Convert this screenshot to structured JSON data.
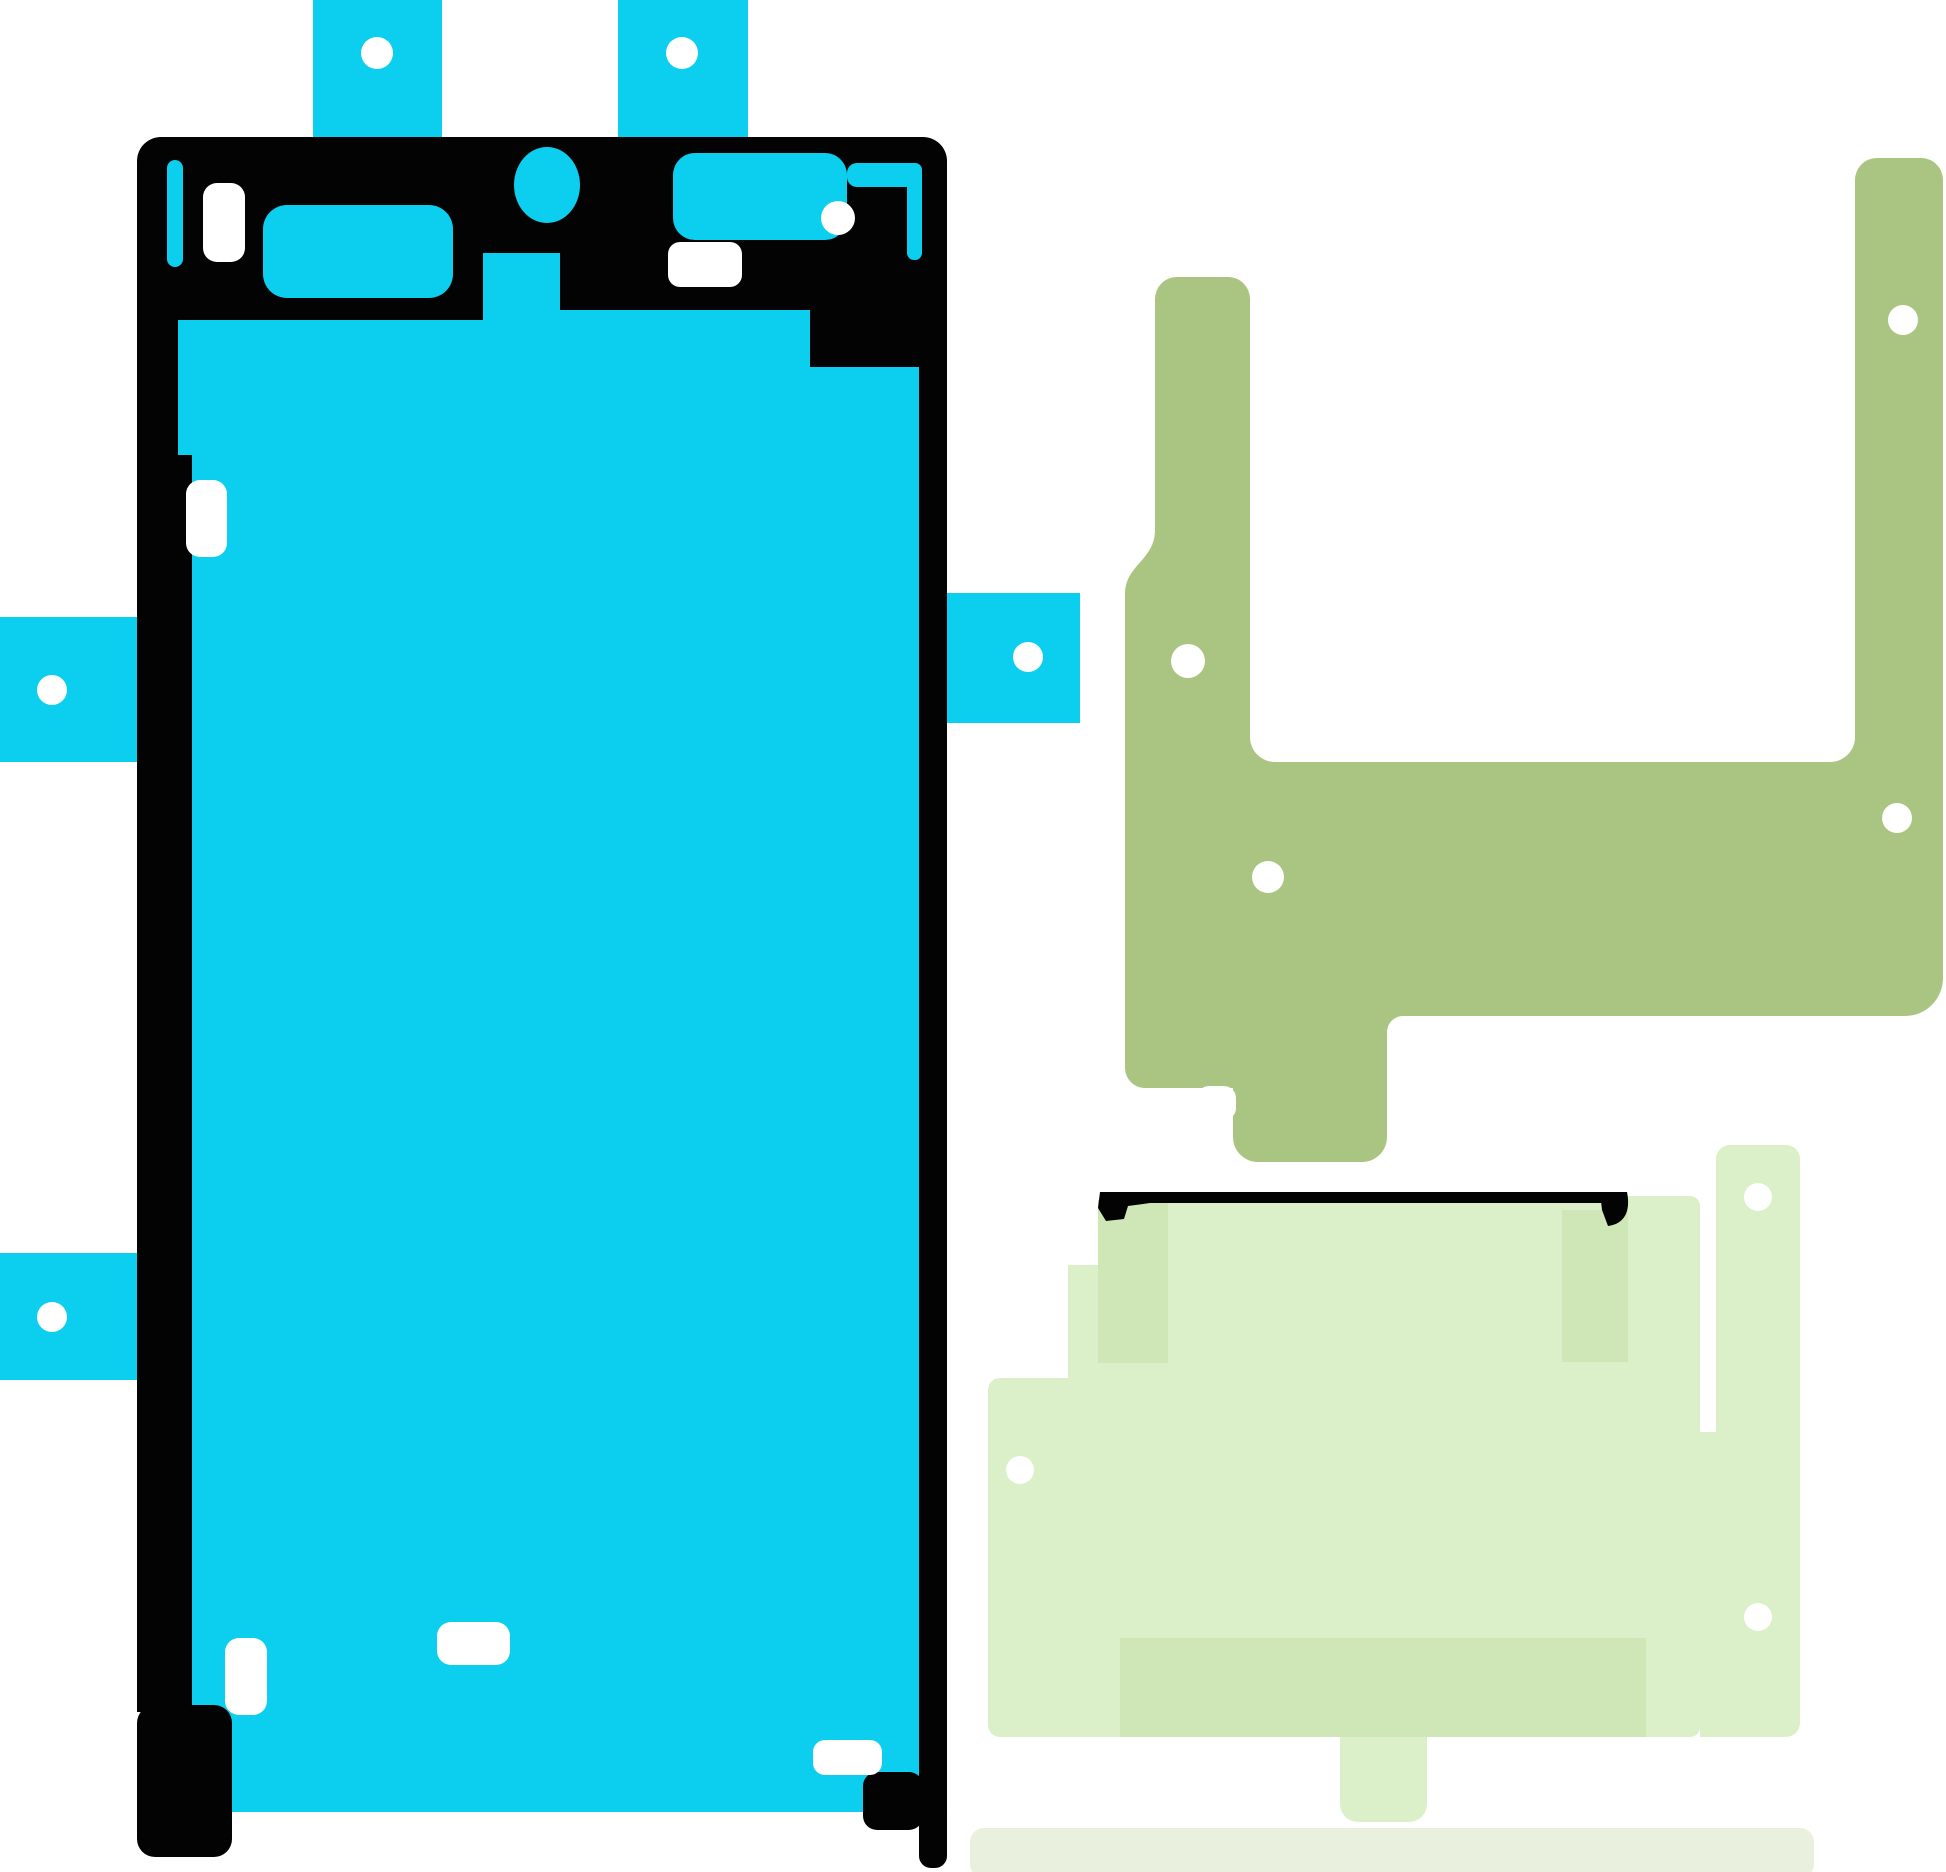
{
  "image": {
    "width": 1946,
    "height": 1872,
    "background": "#ffffff",
    "kind": "adhesive-rework-kit-product-image",
    "text_content": "none"
  },
  "colors": {
    "cyan": "#0cceee",
    "black": "#030303",
    "olive": "#a9c581",
    "light_green": "#dbf0c8",
    "medium_green": "#cfe7b6",
    "pale_green": "#eaf0de",
    "white": "#ffffff"
  },
  "pieces": {
    "display_adhesive": {
      "name": "display-gasket-adhesive",
      "color_key": "cyan",
      "liner_tab_holes": [
        {
          "cx": 377,
          "cy": 53,
          "r": 16
        },
        {
          "cx": 682,
          "cy": 53,
          "r": 16
        },
        {
          "cx": 52,
          "cy": 690,
          "r": 15
        },
        {
          "cx": 52,
          "cy": 1317,
          "r": 15
        },
        {
          "cx": 1028,
          "cy": 657,
          "r": 15
        }
      ],
      "inner_holes": [
        {
          "cx": 838,
          "cy": 218,
          "r": 17
        }
      ]
    },
    "bracket_adhesive": {
      "name": "bracket-adhesive-u-shape",
      "color_key": "olive",
      "holes": [
        {
          "cx": 1188,
          "cy": 661,
          "r": 17
        },
        {
          "cx": 1903,
          "cy": 320,
          "r": 15
        },
        {
          "cx": 1897,
          "cy": 818,
          "r": 15
        },
        {
          "cx": 1268,
          "cy": 877,
          "r": 16
        }
      ]
    },
    "battery_adhesive": {
      "name": "battery-adhesive-stack",
      "color_key": "light_green",
      "holes": [
        {
          "cx": 1020,
          "cy": 1470,
          "r": 14
        },
        {
          "cx": 1758,
          "cy": 1197,
          "r": 14
        },
        {
          "cx": 1758,
          "cy": 1617,
          "r": 14
        }
      ]
    }
  }
}
